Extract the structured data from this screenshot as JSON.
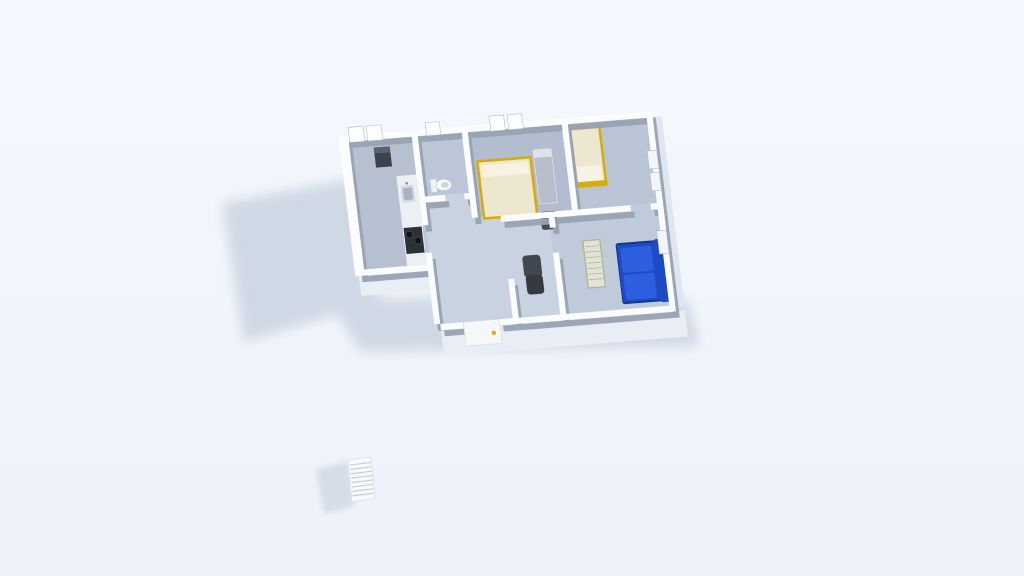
{
  "scene": {
    "type": "3d-floor-plan-render",
    "view": "aerial-oblique",
    "rooms": [
      "kitchen",
      "bathroom",
      "bedroom-1",
      "bedroom-2",
      "hallway",
      "living-room",
      "entry"
    ],
    "furniture": [
      "kitchen-counter",
      "sink",
      "stove",
      "refrigerator",
      "toilet",
      "double-bed",
      "wardrobe",
      "chair",
      "single-bed",
      "dark-armchair",
      "blue-sofa",
      "slatted-bench",
      "front-door",
      "radiator-outside"
    ],
    "window_count": 8,
    "door_count": 1
  },
  "palette": {
    "bg_top": "#f5f8fe",
    "bg_bottom": "#eef2f8",
    "shadow": "#c7d1e0",
    "wall_top": "#fbfcfe",
    "wall_face": "#98a2b3",
    "wall_outer": "#e9edf4",
    "wall_outer_right": "#e0e6ef",
    "wall_outer_left": "#fdfdff",
    "floor_kitchen": "#b6c0d1",
    "floor_bath": "#bcc6d6",
    "floor_bed1": "#b2bdd0",
    "floor_bed2": "#b9c4d5",
    "floor_hall": "#c9d2e0",
    "floor_living": "#bfcada",
    "window_fill": "#fcfdfe",
    "window_side": "#f2f5f9",
    "window_stroke": "#b6bfcc",
    "counter": "#ecf0f5",
    "counter_side": "#bfc7d3",
    "sink": "#d4dae3",
    "sink_inner": "#a9b2c0",
    "faucet": "#7d8694",
    "stove": "#2c3138",
    "burner": "#111418",
    "burner_ring": "#4a5059",
    "appliance": "#3c424b",
    "appliance_top": "#596070",
    "toilet": "#f8fafc",
    "toilet_inner": "#cfd6df",
    "toilet_stroke": "#c6cdd7",
    "toilet_tank": "#eef1f5",
    "bed_frame": "#d7ac07",
    "bed_linen": "#ede7cf",
    "pillow": "#f7f2e2",
    "wardrobe": "#b8bfca",
    "wardrobe_top": "#dde1e8",
    "chair": "#474c55",
    "chair_dark": "#32363d",
    "armchair": "#41464f",
    "armchair_dark": "#343942",
    "sofa_base": "#16378f",
    "sofa": "#1d4bc4",
    "sofa_cushion": "#2d5ee0",
    "bench_fill": "#dfe3da",
    "bench_frame": "#b5b583",
    "door": "#f6f7f9",
    "door_stroke": "#d6dce4",
    "handle": "#d8b400",
    "radiator": "#f7f9fb",
    "radiator_stroke": "#d9dee6",
    "radiator_slat": "#c3cad6",
    "radiator_shadow": "#ccd5e3"
  }
}
